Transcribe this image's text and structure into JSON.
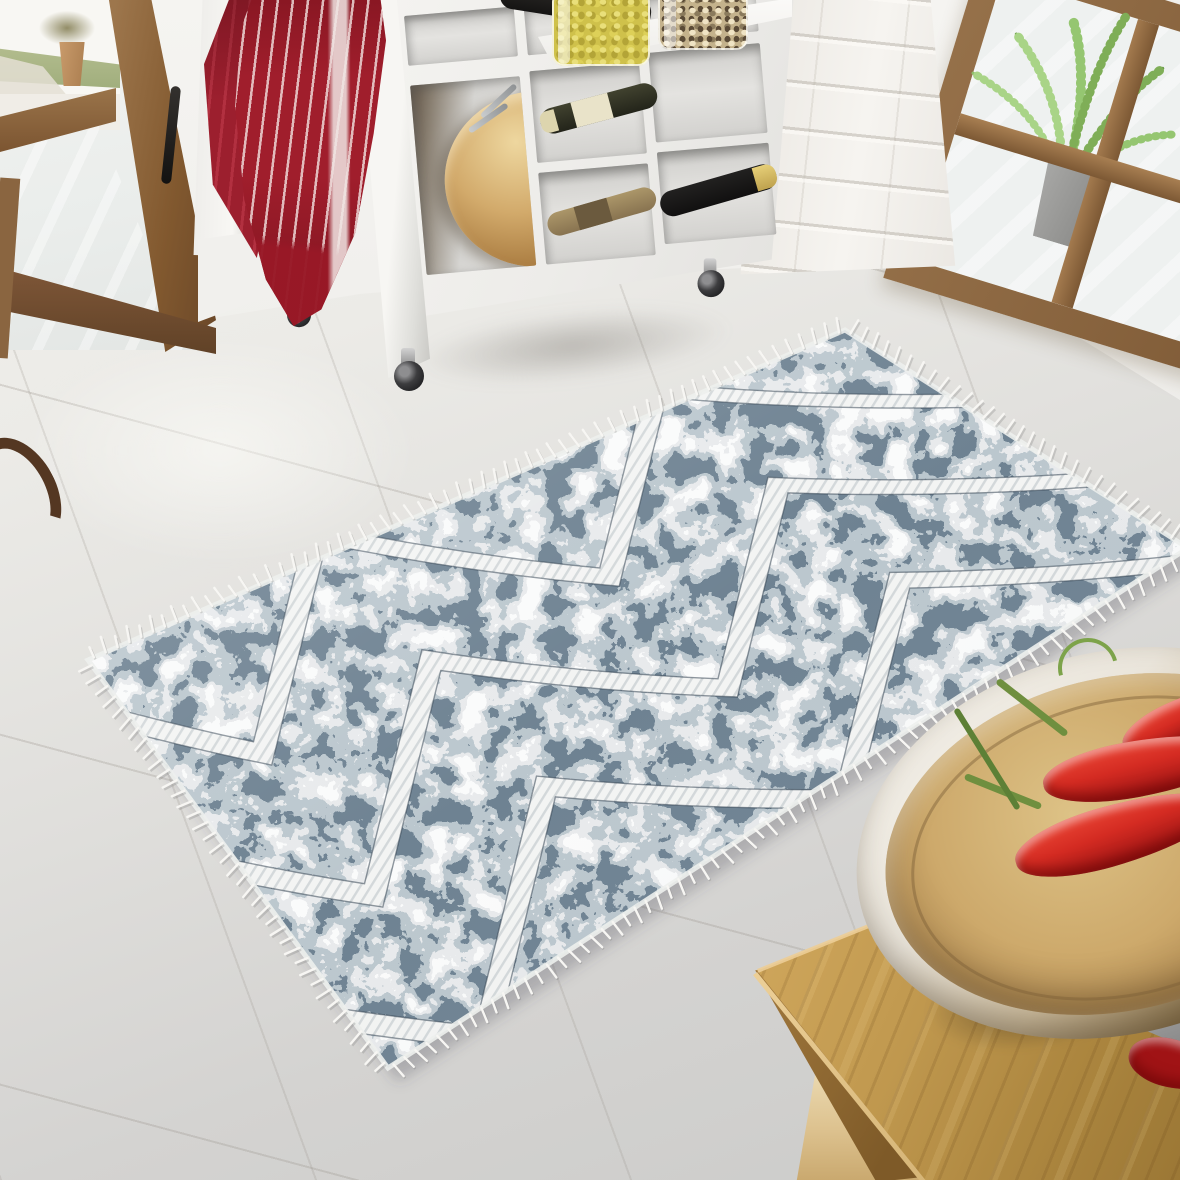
{
  "scene": {
    "description": "Bright kitchen entry photographed for a rug product listing: a distressed navy-and-grey chevron area rug with white fringe lies on large light tiles between wooden glass doors, a white cube storage cart, a white painted brick pillar and an oak side table holding a bamboo bowl of red chili peppers.",
    "lighting": "daylight from glass doors, upper left"
  },
  "palette": {
    "floor_light": "#f2f0ec",
    "floor_dark": "#cbcbc9",
    "grout": "#9b958c",
    "wall_white": "#f4f3f0",
    "brick_shadow": "#d8d3cb",
    "door_wood": "#8f6b41",
    "door_wood_dark": "#6a4728",
    "towel_red": "#a01e2c",
    "towel_red_dark": "#7e1622",
    "towel_stripe": "#f2e2e0",
    "cart_white": "#f1f0ed",
    "cubby_shadow": "#b5b4b1",
    "salad_bowl_wood": "#d2aa6b",
    "bottle_dark": "#1c1b19",
    "bottle_label_cream": "#e9e3c9",
    "bottle_capsule_gold": "#d9c26a",
    "bottle_cork": "#a9946a",
    "jar_pasta_yellow": "#cfc14b",
    "jar_muesli": "#c4b28c",
    "fern_green": "#7fae57",
    "pot_gray": "#9b9b99",
    "rug_navy": "#28394a",
    "rug_gray_blue": "#7f929e",
    "rug_light_gray": "#cdd3d6",
    "rug_white": "#f4f5f5",
    "rug_fringe": "#f7f6f3",
    "rug_band_outline": "#2b3b4b",
    "rug_band_hatch": "#d3d8da",
    "table_oak": "#c29a50",
    "table_leg_light": "#e6d0a2",
    "bamboo_bowl_inner": "#cda96b",
    "bamboo_bowl_outer": "#efece5",
    "chili_red": "#d42b22",
    "chili_dark": "#9d1414",
    "stem_green": "#6f8f3f",
    "knife_steel": "#c9c9c9"
  },
  "rug": {
    "style": "distressed zigzag chevron kilim with tassel fringe",
    "corners": {
      "w": [
        88,
        660
      ],
      "n": [
        845,
        330
      ],
      "e": [
        1188,
        548
      ],
      "s": [
        388,
        1068
      ]
    },
    "shadow_offset": [
      10,
      14
    ],
    "bands": {
      "centers": [
        0.135,
        0.5,
        0.865
      ],
      "amplitude": 0.19,
      "half_thickness": 0.03,
      "period": 0.45,
      "phase": 0.1
    },
    "fringe": {
      "spacing": 13,
      "length": 14
    },
    "colors": {
      "navy": "#28394a",
      "gray": "#7f929e",
      "light": "#cdd3d6",
      "white": "#f4f5f5",
      "band_fill": "#f3f4f3",
      "band_hatch": "#d3d8da",
      "outline": "rgba(38,54,70,0.5)",
      "selvage": "#edefed",
      "fringe": "#f7f6f3",
      "fringe_shadow": "rgba(110,110,110,0.25)",
      "shadow": "rgba(70,70,78,0.28)"
    }
  },
  "objects": [
    {
      "name": "glass-door-left",
      "material": "pine wood frame",
      "view": "patio, grass and a potted shrub outside"
    },
    {
      "name": "tea-towel",
      "pattern": "red with thin white stripes and one wide white band"
    },
    {
      "name": "storage-cart",
      "color": "white",
      "wheels": 3,
      "contents": [
        "dark wine bottle",
        "wine bottle with cream label",
        "cork-colored bottle",
        "dark bottle with gold capsule",
        "wooden salad bowl with servers",
        "glass jar of yellow pasta",
        "glass jar of muesli"
      ]
    },
    {
      "name": "white-brick-pillar"
    },
    {
      "name": "window-frame-right",
      "material": "pine wood",
      "plant": "asparagus fern in gray pot"
    },
    {
      "name": "area-rug",
      "colors": [
        "navy",
        "gray-blue",
        "white"
      ],
      "fringed_edges": true,
      "zigzag_bands": 3
    },
    {
      "name": "oak-side-table"
    },
    {
      "name": "bamboo-bowl",
      "contents": "red chili peppers"
    },
    {
      "name": "kitchen-knife"
    },
    {
      "name": "chili-peppers",
      "count": 5
    },
    {
      "name": "dark-wood-hook",
      "position": "left edge"
    }
  ]
}
